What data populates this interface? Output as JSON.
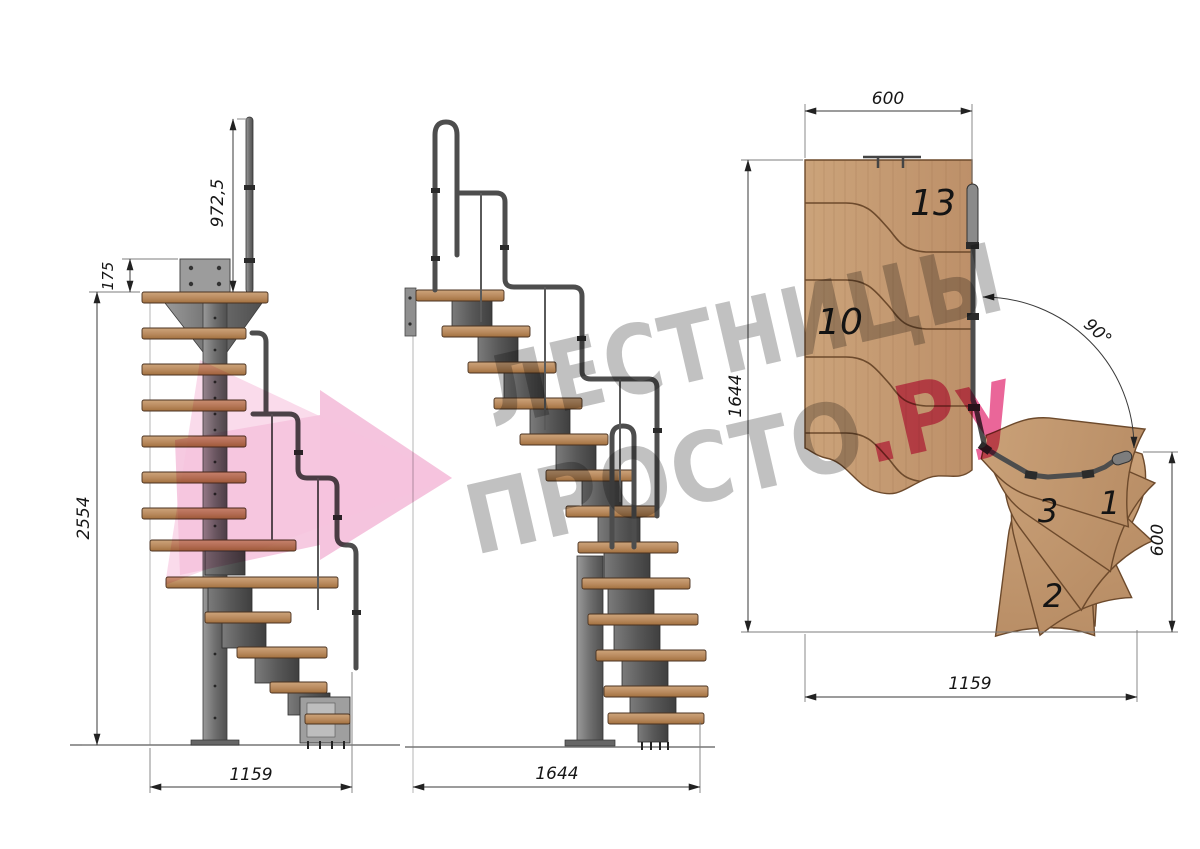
{
  "watermark": {
    "line1": "ЛЕСТНИЦЫ",
    "line2_gray": "ПРОСТО",
    "line2_pink": ".Ру",
    "gray_color": "#9b9b9b",
    "pink_color": "#e33377"
  },
  "side_view": {
    "dim_rail_height": "972,5",
    "dim_bracket_plate": "175",
    "dim_total_height": "2554",
    "dim_run_length": "1159"
  },
  "front_view": {
    "dim_run_length": "1644"
  },
  "plan_view": {
    "dim_top_width": "600",
    "dim_flight_length": "1644",
    "dim_turn_angle": "90°",
    "dim_exit_width": "600",
    "dim_bottom_length": "1159",
    "step_labels": {
      "top": "13",
      "middle": "10",
      "winder_3": "3",
      "winder_2": "2",
      "winder_1": "1"
    }
  },
  "colors": {
    "wood_light": "#cda57c",
    "wood_dark": "#a97a4e",
    "steel": "#6e6e6e",
    "rail": "#4d4d4d",
    "dim_line": "#3a3a3a"
  }
}
